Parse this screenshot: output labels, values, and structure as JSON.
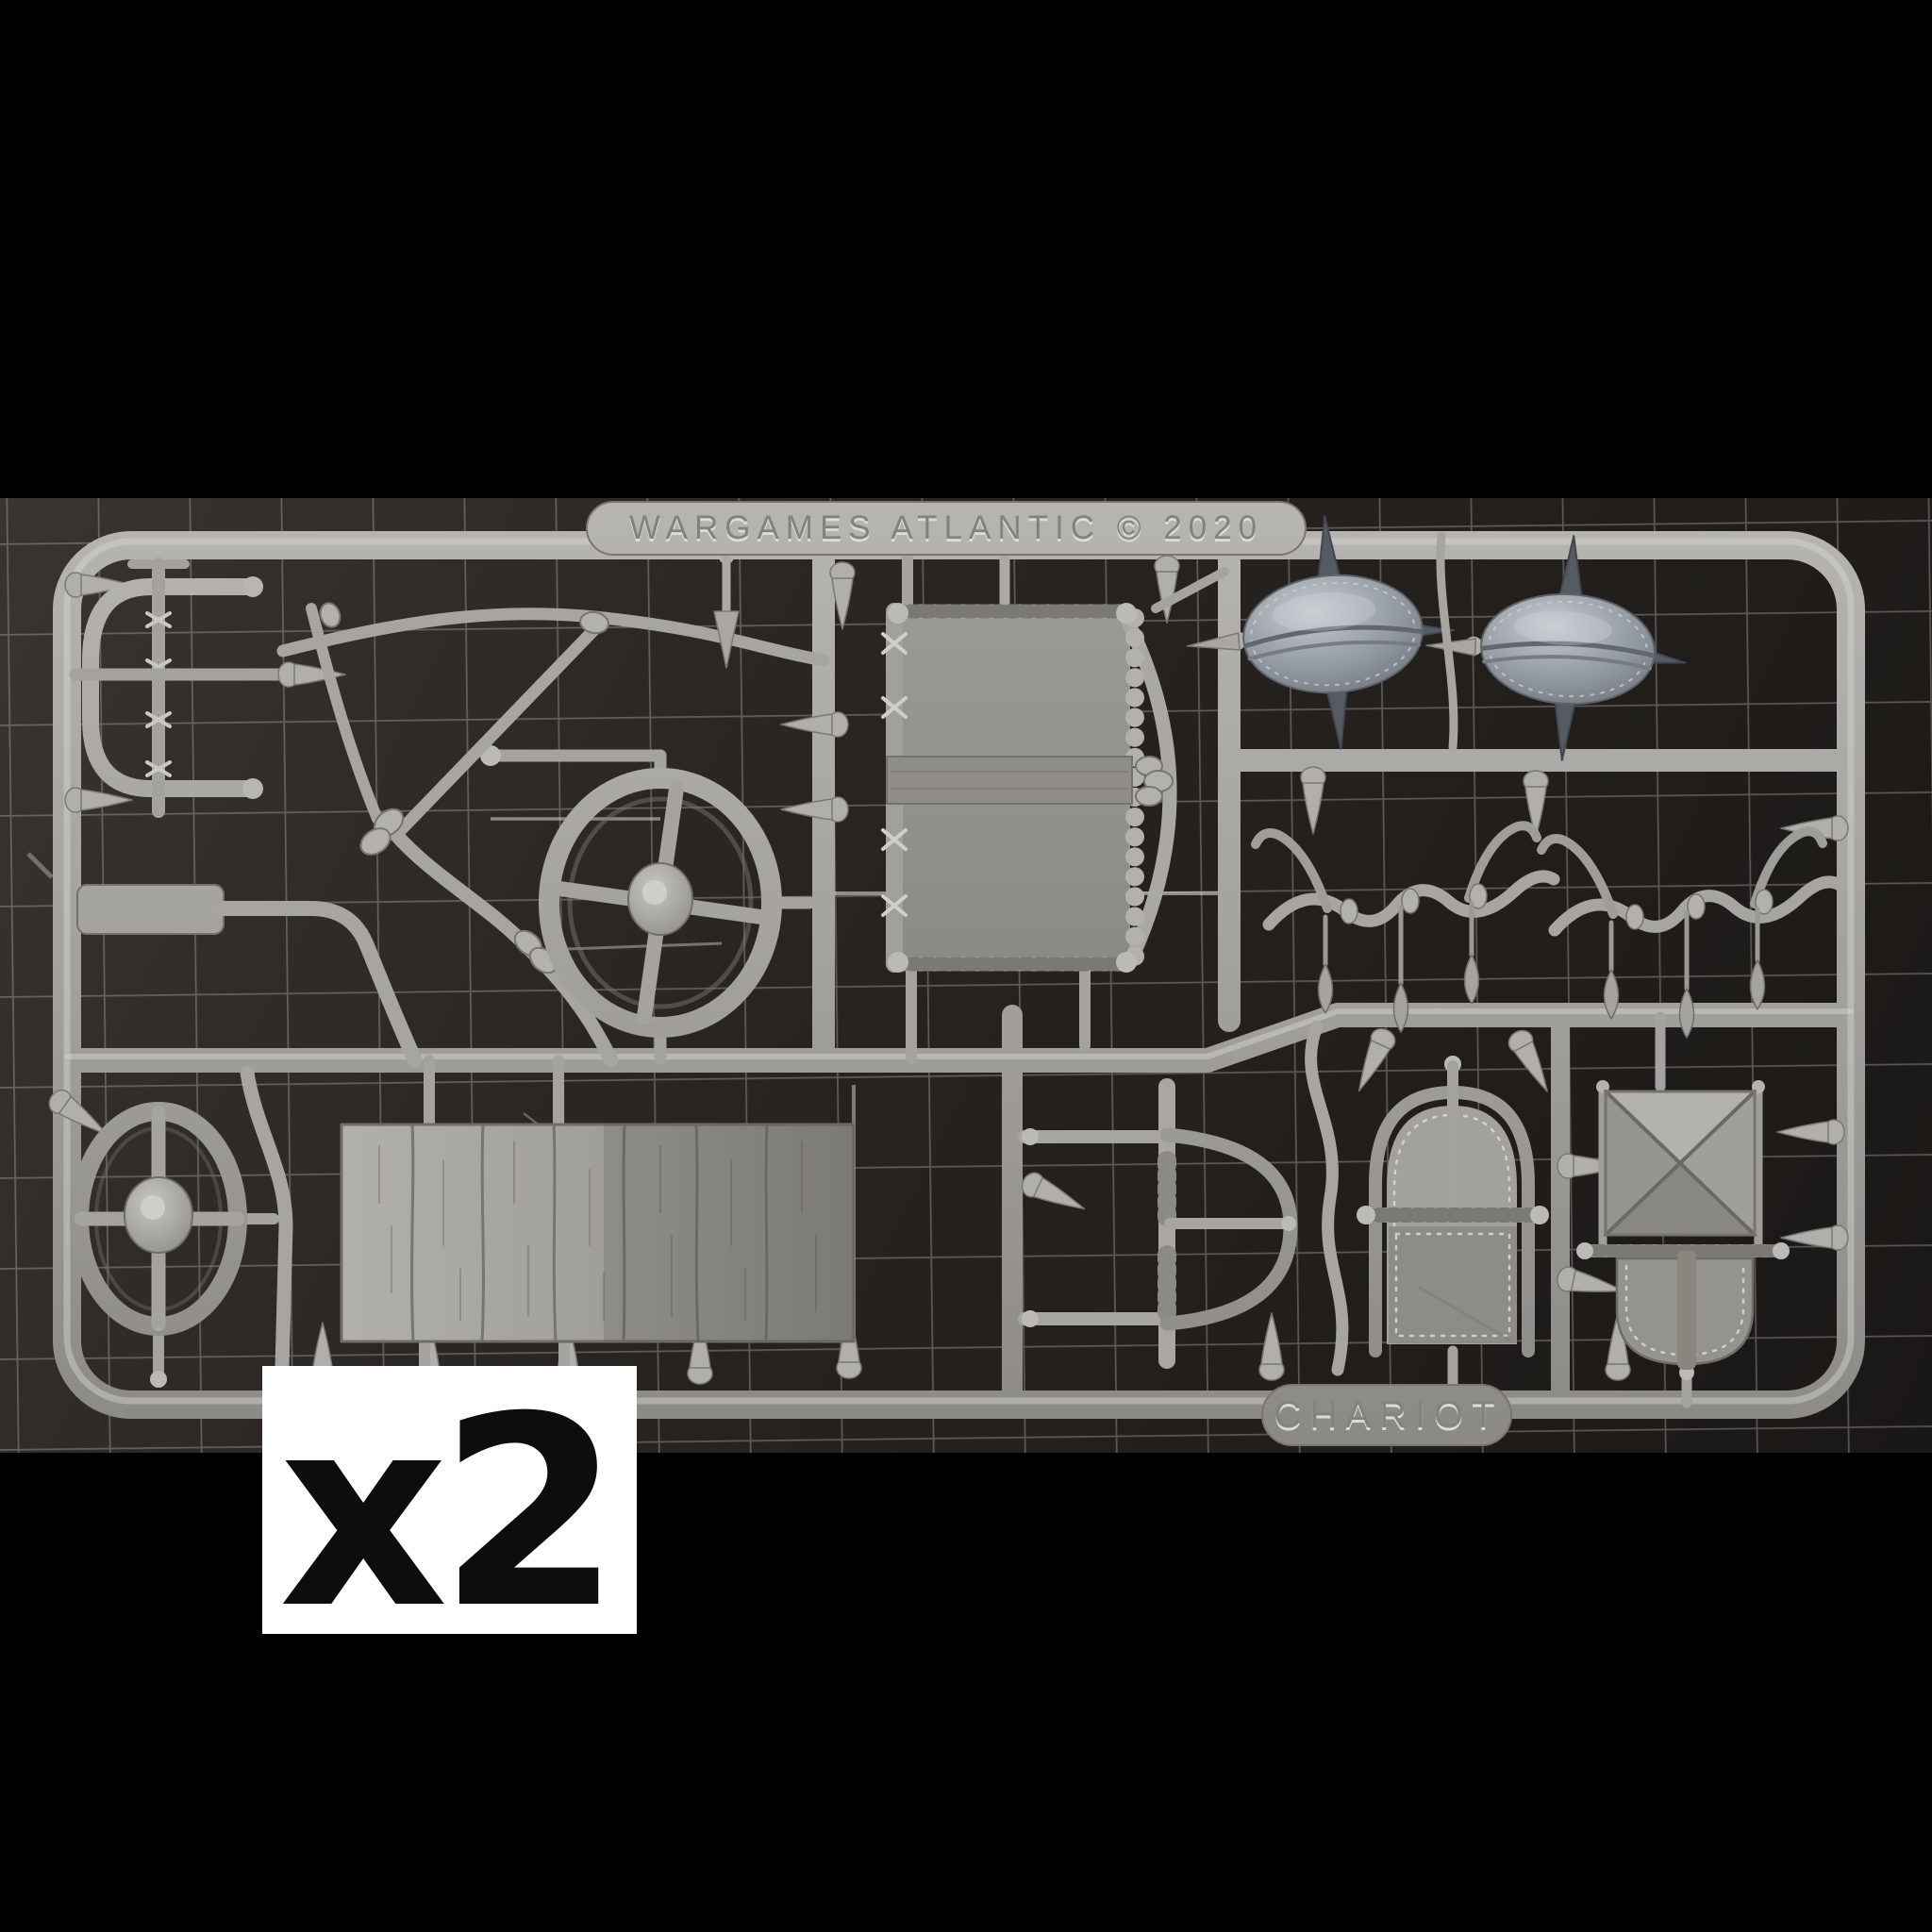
{
  "photo": {
    "banner_label": "WARGAMES ATLANTIC © 2020",
    "sprue_tag": "CHARIOT",
    "quantity_label": "x2",
    "colors": {
      "background": "#000000",
      "mat": "#262220",
      "grid_line": "#b8b6b0",
      "plastic": "#a9a7a3",
      "plastic_highlight": "#d8d7d3",
      "plastic_shadow": "#7d7b77",
      "steel_shield": "#8d929a",
      "spike_dark": "#565b63",
      "quantity_box_bg": "#ffffff",
      "quantity_box_text": "#0d0d0d"
    }
  }
}
